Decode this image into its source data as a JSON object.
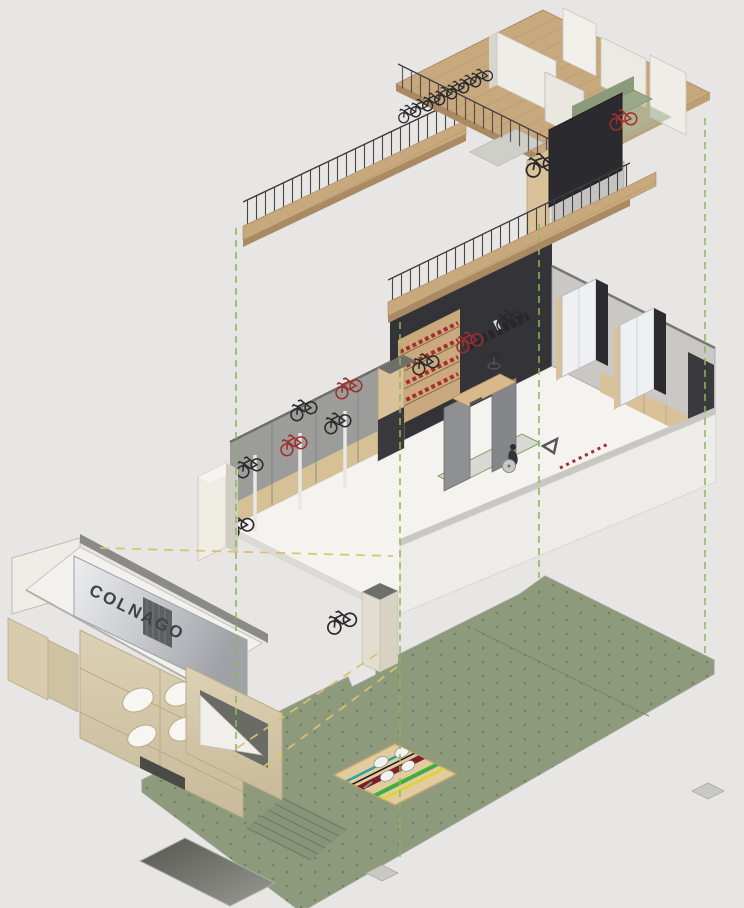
{
  "meta": {
    "type": "exploded-axonometric-interior-render",
    "subject": "Colnago bicycle shop shown as three exploded levels with projection lines"
  },
  "sign": {
    "label": "COLNAGO"
  },
  "levels": {
    "mezzanine": {
      "name": "mezzanine-level",
      "display_bike_count": 7,
      "trainer_bike_count": 2,
      "features": [
        "wood ramp with railing",
        "railed walkway",
        "white partition walls",
        "dark media screen",
        "green lounge seating",
        "row of display bikes"
      ]
    },
    "retail": {
      "name": "retail-floor",
      "wall_bike_count": 8,
      "features": [
        "bike display wall",
        "white rack poles",
        "shelving with red merchandise",
        "apparel rail",
        "blue light strip",
        "two fitting rooms",
        "storage cabinets",
        "bike-fit station",
        "office chair",
        "entrance column with mounted bike",
        "low front wall"
      ]
    },
    "street": {
      "name": "street-facade",
      "features": [
        "white canopy roof",
        "metal fascia sign",
        "stone pillar with clover relief",
        "side entrance opening",
        "stone plinths"
      ]
    },
    "ground": {
      "name": "ground-slab",
      "features": [
        "green paved plaza",
        "recessed pit",
        "entry steps",
        "logo mat with champion stripes",
        "column pads"
      ]
    }
  },
  "logo_mat": {
    "stripe_colors": [
      "teal",
      "black",
      "maroon",
      "green",
      "yellow"
    ],
    "emblem": "clover"
  },
  "projection_lines": {
    "vertical": "green dashed",
    "facade": "yellow dashed"
  },
  "palette": {
    "bg": "#e7e6e4",
    "wood": "#c8a87d",
    "wood-line": "#b2916a",
    "wood-edge": "#a98a63",
    "wall-white": "#efede7",
    "wall-shade": "#d9d6cd",
    "edge": "#8c8c88",
    "gray-wall": "#9c9c9a",
    "dark-wall": "#333338",
    "screen": "#2b2b2f",
    "tan": "#d9c29a",
    "tan-light": "#e8e0cc",
    "stone": "#d9ccae",
    "stone-line": "#b9aa8a",
    "metal-1": "#e9eaec",
    "metal-2": "#a9abb0",
    "sign-text": "#3f4246",
    "floor-white": "#f4f3f0",
    "slab": "#8e9a7c",
    "slab-dot": "#6f7c60",
    "slab-dark": "#87947a",
    "pit-1": "#55554f",
    "pit-2": "#9a9a94",
    "mat": "#e3cba0",
    "mat-border": "#c9a86e",
    "dash-green": "#8cb857",
    "dash-yellow": "#d8c36c",
    "red": "#a82c2c",
    "blue": "#2e9fc4",
    "sofa": "#9aa98a",
    "sofa-dark": "#8a9a7a",
    "rail": "#3d3d3f",
    "bike": "#2a2a2c",
    "bike-red": "#9e2f2f",
    "pad": "#c9c9c4"
  }
}
